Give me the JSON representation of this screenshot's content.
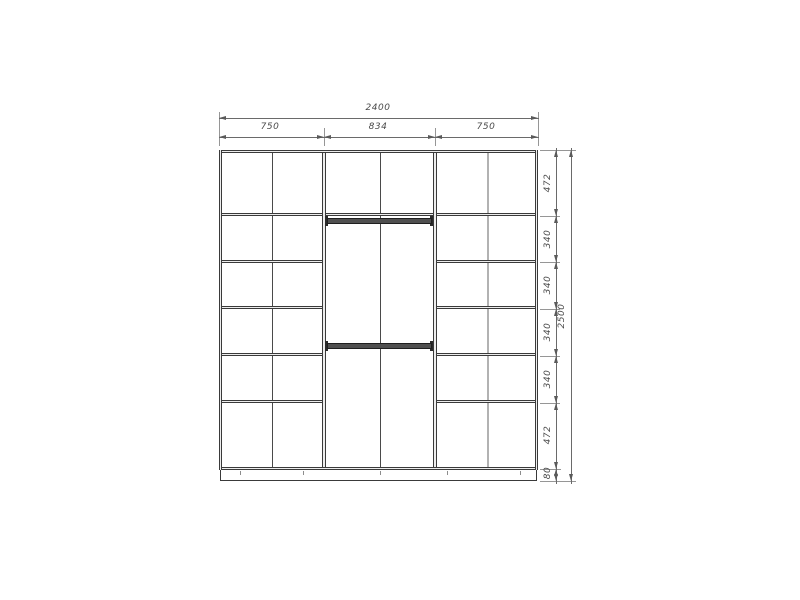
{
  "horizontal_dimensions": {
    "total": "2400",
    "sections": [
      "750",
      "834",
      "750"
    ]
  },
  "vertical_dimensions": {
    "total": "2500",
    "rows": [
      "472",
      "340",
      "340",
      "340",
      "340",
      "472"
    ],
    "base": "80"
  },
  "colors": {
    "background": "#ffffff",
    "carcass_line": "#3a3a3a",
    "dimension_line": "#6a6a6a",
    "dimension_text": "#4a4a4a",
    "secondary_line": "#b2b2b2"
  }
}
